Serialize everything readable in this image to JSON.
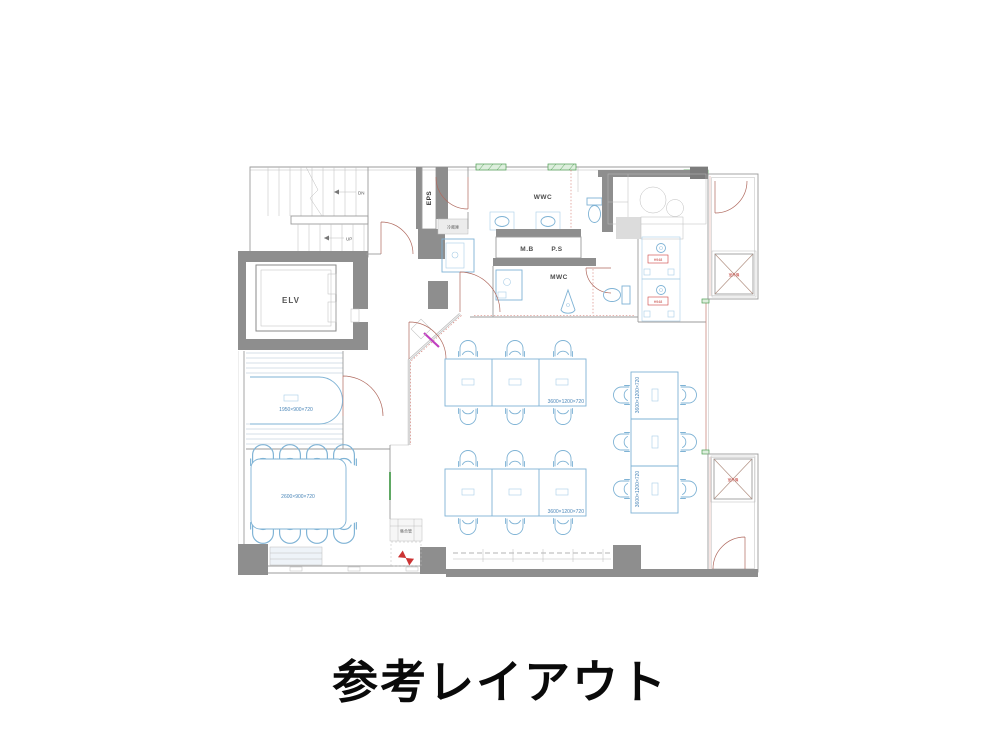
{
  "caption": "参考レイアウト",
  "plan": {
    "labels": {
      "dn": "DN",
      "up": "UP",
      "elv": "ELV",
      "eps": "EPS",
      "refrigerator": "冷蔵庫",
      "wwc": "WWC",
      "mb": "M.B",
      "ps": "P.S",
      "mwc": "MWC",
      "meeting_table": "1950×900×720",
      "lounge_table": "2600×900×720",
      "desk_bank_a": "3600×1200×720",
      "desk_bank_b": "3600×1200×720",
      "desk_bank_c_top": "3600×1200×720",
      "desk_bank_c_bottom": "3600×1200×720",
      "pipe_box": "集合管",
      "appliance_1": "H948",
      "appliance_2": "H948",
      "outdoor_unit_top": "室外機",
      "outdoor_unit_bottom": "室外機"
    },
    "colors": {
      "wall": "#8e8e8e",
      "furniture_blue": "#7fb3d5",
      "dimension_blue": "#4a86b8",
      "door_red": "#b06a5f",
      "accent_green": "#4f9e53",
      "accent_magenta": "#c03fc0",
      "alert_red": "#cc3333"
    }
  }
}
